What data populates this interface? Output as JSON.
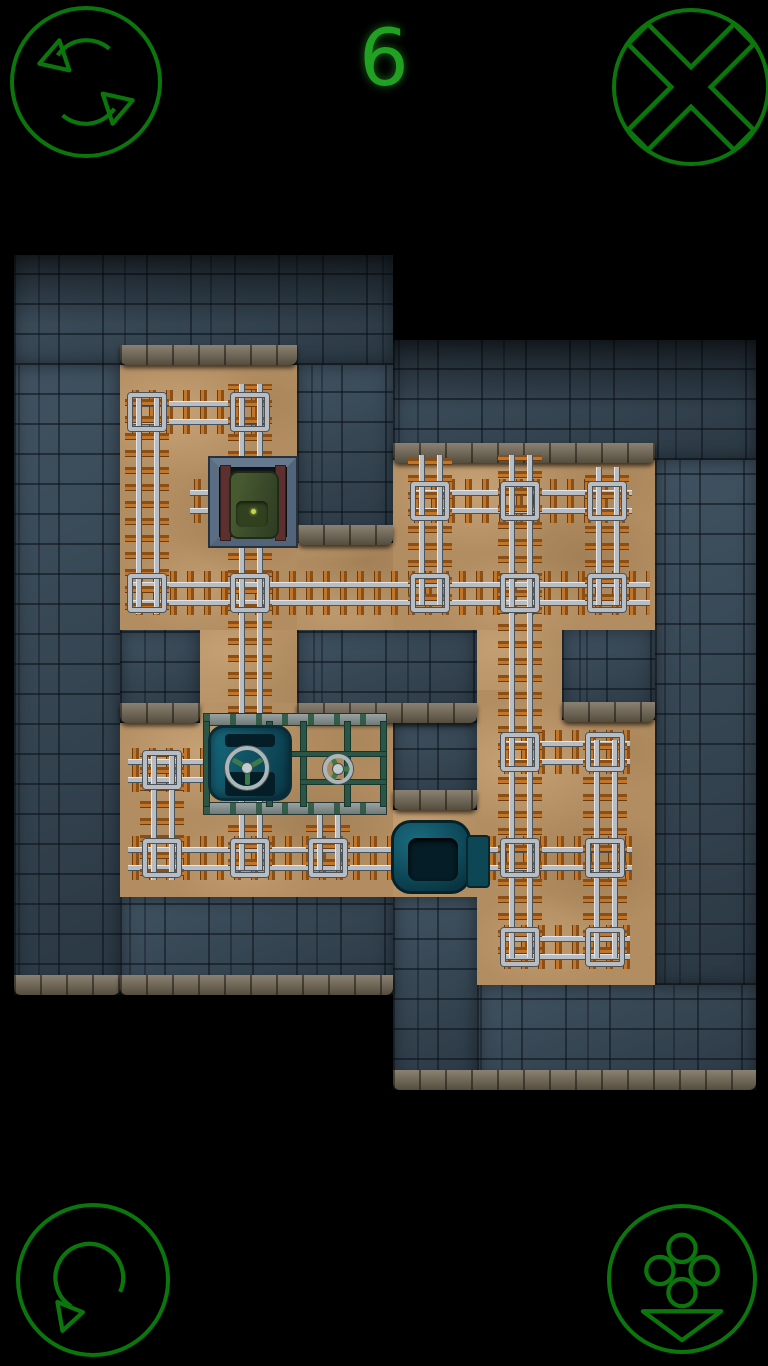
{
  "hud": {
    "counter": "6",
    "accent": "#0b760b",
    "counter_color": "#21a121",
    "buttons": [
      {
        "name": "restart-button",
        "icon": "cycle-arrows-icon"
      },
      {
        "name": "close-button",
        "icon": "x-cross-icon"
      },
      {
        "name": "undo-rotate-button",
        "icon": "rotate-ccw-arrow-icon"
      },
      {
        "name": "controls-button",
        "icon": "gamepad-buttons-icon"
      }
    ]
  },
  "board": {
    "colors": {
      "background": "#000000",
      "sand": "#b28d62",
      "stone": "#31404c",
      "wall_lip": "#6e6456",
      "tie": "#c1762c",
      "rail": "#b7bdc3",
      "scaffold_green": "#2b5547",
      "machine_teal": "#0f4d5f",
      "wagon_green": "#3c4e2a",
      "dock_steel": "#51647a",
      "hud_green": "#0b760b"
    },
    "sand_zones": [
      [
        120,
        345,
        177,
        285
      ],
      [
        297,
        460,
        96,
        170
      ],
      [
        393,
        443,
        262,
        187
      ],
      [
        200,
        630,
        97,
        93
      ],
      [
        477,
        630,
        85,
        62
      ],
      [
        120,
        703,
        273,
        194
      ],
      [
        455,
        690,
        200,
        295
      ],
      [
        393,
        808,
        84,
        89
      ]
    ],
    "stone_zones": [
      [
        14,
        255,
        379,
        110,
        "shade"
      ],
      [
        14,
        365,
        106,
        630
      ],
      [
        297,
        365,
        96,
        178
      ],
      [
        393,
        340,
        363,
        120,
        "shade"
      ],
      [
        655,
        460,
        101,
        525
      ],
      [
        120,
        630,
        80,
        93
      ],
      [
        297,
        630,
        180,
        93
      ],
      [
        393,
        723,
        84,
        87
      ],
      [
        562,
        630,
        93,
        90
      ],
      [
        120,
        897,
        273,
        98
      ],
      [
        393,
        897,
        84,
        193
      ],
      [
        477,
        985,
        279,
        105
      ]
    ],
    "wall_lips": [
      [
        120,
        345,
        177,
        20
      ],
      [
        393,
        443,
        262,
        20
      ],
      [
        297,
        525,
        96,
        20
      ],
      [
        120,
        703,
        80,
        20
      ],
      [
        297,
        703,
        180,
        20
      ],
      [
        562,
        702,
        93,
        20
      ],
      [
        393,
        790,
        84,
        20
      ],
      [
        14,
        975,
        106,
        20
      ],
      [
        120,
        975,
        273,
        20
      ],
      [
        393,
        1070,
        363,
        20
      ]
    ],
    "h_tracks": [
      [
        128,
        265,
        412
      ],
      [
        132,
        650,
        593
      ],
      [
        128,
        632,
        858
      ],
      [
        500,
        630,
        752
      ],
      [
        500,
        630,
        947
      ],
      [
        128,
        212,
        770
      ],
      [
        410,
        632,
        501
      ],
      [
        190,
        215,
        501
      ]
    ],
    "v_tracks": [
      [
        392,
        614,
        147
      ],
      [
        384,
        870,
        250
      ],
      [
        810,
        870,
        328
      ],
      [
        455,
        958,
        520
      ],
      [
        455,
        605,
        430
      ],
      [
        467,
        605,
        607
      ],
      [
        740,
        958,
        605
      ],
      [
        753,
        880,
        162
      ]
    ],
    "track_frames": [
      [
        147,
        412
      ],
      [
        250,
        412
      ],
      [
        147,
        593
      ],
      [
        250,
        593
      ],
      [
        430,
        593
      ],
      [
        520,
        593
      ],
      [
        607,
        593
      ],
      [
        430,
        501
      ],
      [
        520,
        501
      ],
      [
        607,
        501
      ],
      [
        162,
        858
      ],
      [
        250,
        858
      ],
      [
        328,
        858
      ],
      [
        520,
        858
      ],
      [
        605,
        858
      ],
      [
        520,
        752
      ],
      [
        605,
        752
      ],
      [
        520,
        947
      ],
      [
        605,
        947
      ],
      [
        162,
        770
      ]
    ],
    "entities": [
      {
        "name": "loading-dock"
      },
      {
        "name": "green-wagon"
      },
      {
        "name": "tank-machine"
      },
      {
        "name": "valve-wheel-large"
      },
      {
        "name": "valve-wheel-small"
      },
      {
        "name": "cargo-machine"
      }
    ]
  }
}
